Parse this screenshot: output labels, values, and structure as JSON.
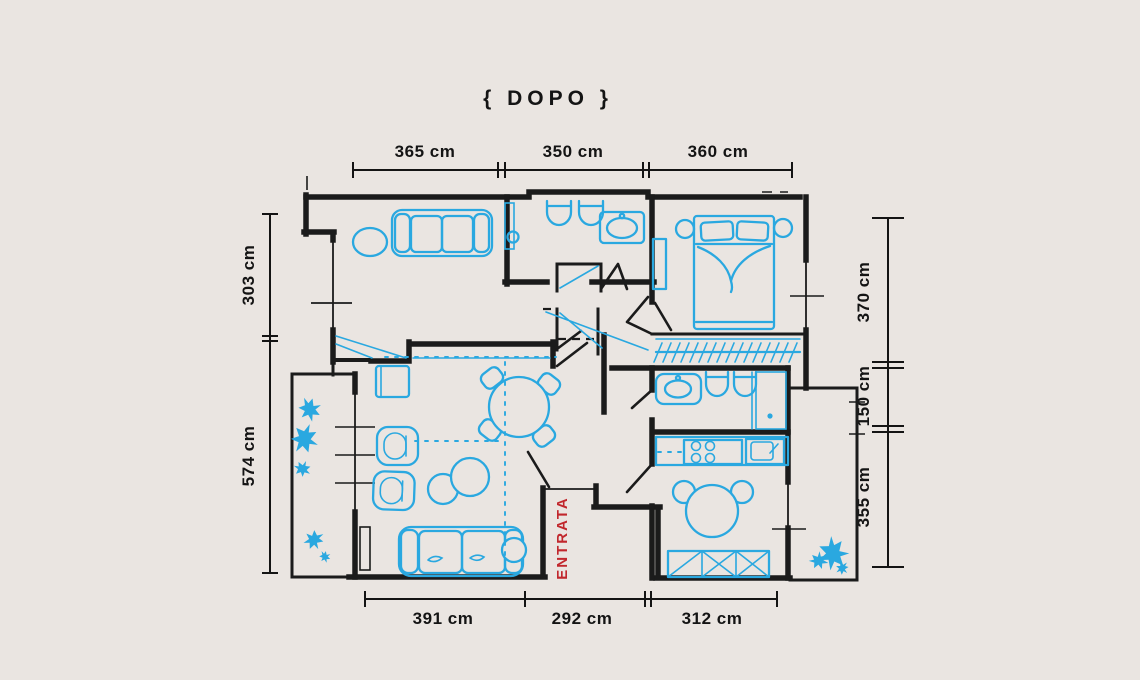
{
  "title": "{ DOPO }",
  "plan": {
    "entrance_label": "ENTRATA"
  },
  "dimensions": {
    "top": [
      "365 cm",
      "350 cm",
      "360 cm"
    ],
    "left": [
      "303 cm",
      "574 cm"
    ],
    "right": [
      "370 cm",
      "150 cm",
      "355 cm"
    ],
    "bottom": [
      "391 cm",
      "292 cm",
      "312 cm"
    ]
  },
  "colors": {
    "background": "#eae5e1",
    "walls": "#1b1b1b",
    "furniture": "#2aa8e0",
    "entrance_text": "#c1272d"
  }
}
